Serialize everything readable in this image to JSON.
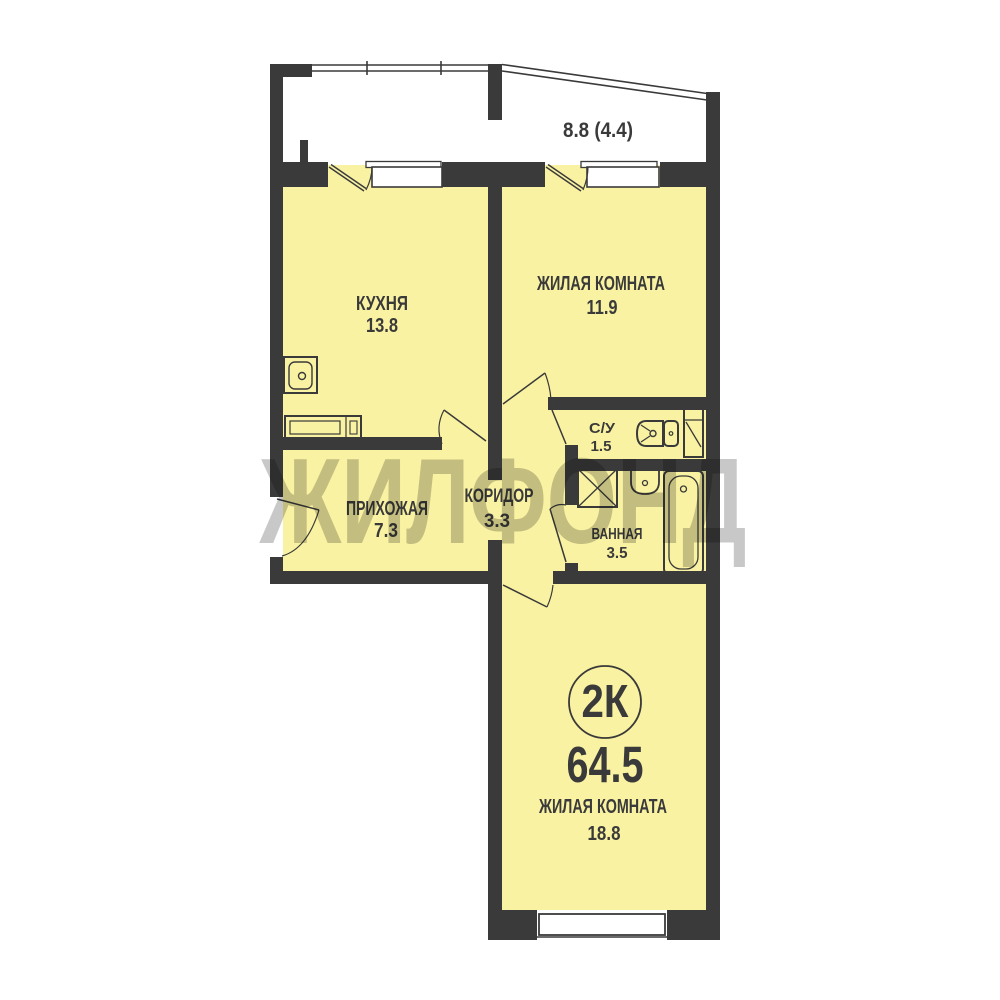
{
  "watermark": {
    "text": "ЖИЛФОНД"
  },
  "plan": {
    "type_badge": "2К",
    "total_area": "64.5"
  },
  "balcony": {
    "area_label": "8.8 (4.4)"
  },
  "rooms": {
    "kitchen": {
      "name": "КУХНЯ",
      "area": "13.8"
    },
    "living_top": {
      "name": "ЖИЛАЯ КОМНАТА",
      "area": "11.9"
    },
    "wc": {
      "name": "С/У",
      "area": "1.5"
    },
    "bathroom": {
      "name": "ВАННАЯ",
      "area": "3.5"
    },
    "hallway": {
      "name": "ПРИХОЖАЯ",
      "area": "7.3"
    },
    "corridor": {
      "name": "КОРИДОР",
      "area": "3.3"
    },
    "living_bottom": {
      "name": "ЖИЛАЯ КОМНАТА",
      "area": "18.8"
    }
  },
  "colors": {
    "walls": "#3a3a3a",
    "room_fill": "#f9f2a2",
    "balcony_fill": "#ffffff",
    "watermark": "#c8c8c8",
    "background": "#ffffff"
  }
}
